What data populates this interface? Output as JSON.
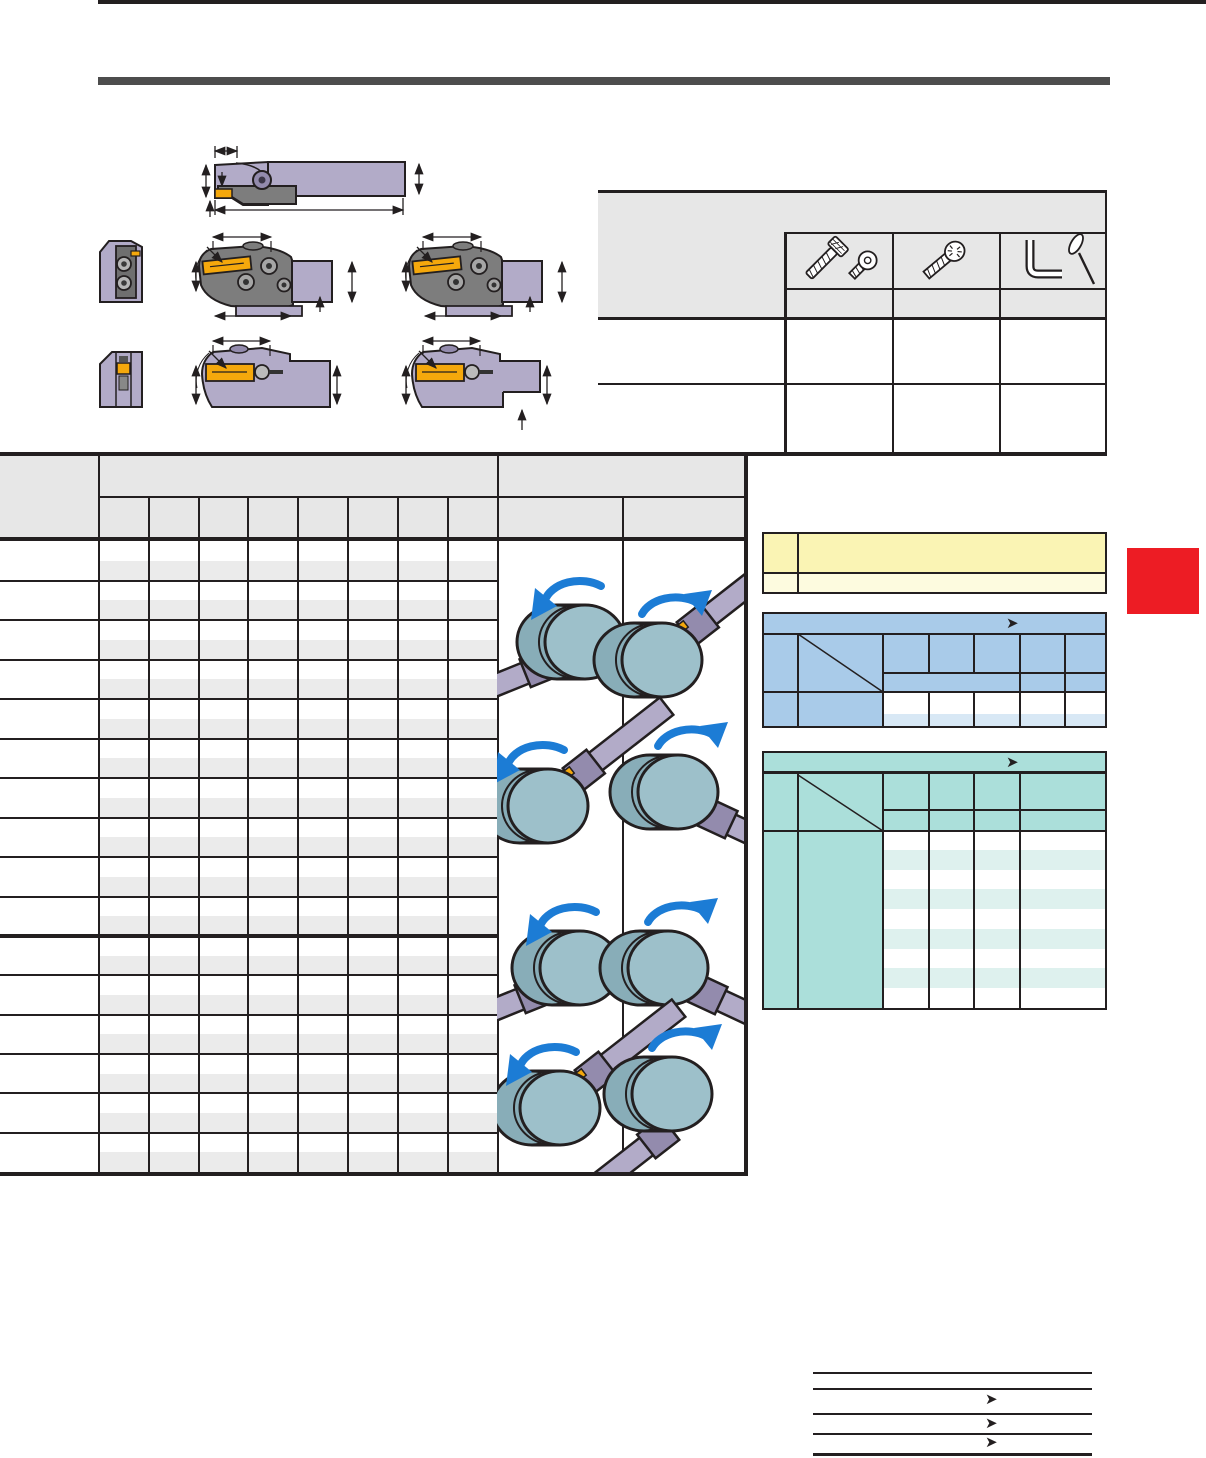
{
  "page": {
    "kind": "tool-catalog-page",
    "top_rule_color": "#231f20",
    "section_rule_color": "#4d4d4d",
    "background": "#ffffff",
    "page_tab_color": "#ed1c24"
  },
  "palette": {
    "border": "#231f20",
    "header_gray": "#e7e7e7",
    "row_stripe_gray": "#ebebeb",
    "holder_purple": "#b2abc8",
    "holder_purple_shade": "#938bad",
    "head_gray": "#7d7d7d",
    "insert_yellow": "#f5a80c",
    "workpiece_face": "#9dc0ca",
    "workpiece_side": "#88adb8",
    "rotation_arrow_blue": "#1c7cd5",
    "note_yellow": "#faf4b4",
    "note_yellow_light": "#fdfbdf",
    "blue_header": "#a9cbe9",
    "blue_stripe": "#d8e8f5",
    "teal_header": "#abdfda",
    "teal_stripe": "#def1ee"
  },
  "technical_drawings": {
    "views": [
      {
        "name": "shank-holder-side-view"
      },
      {
        "name": "modular-head-end-view"
      },
      {
        "name": "modular-head-side-view-right"
      },
      {
        "name": "modular-head-side-view-left"
      },
      {
        "name": "blade-head-end-view"
      },
      {
        "name": "blade-head-side-view-right"
      },
      {
        "name": "blade-head-side-view-left"
      }
    ]
  },
  "spare_parts_table": {
    "columns": [
      {
        "icon": "clamp-screw-icon"
      },
      {
        "icon": "insert-screw-icon"
      },
      {
        "icon": "wrench-screwdriver-icon"
      }
    ],
    "data_row_count": 2
  },
  "main_table": {
    "dimension_subcolumn_count": 8,
    "row_group1_count": 10,
    "row_group2_count": 6,
    "illustration_columns": 2,
    "illustrations": [
      {
        "name": "external-grooving-left-hand",
        "rotation": "counter-clockwise"
      },
      {
        "name": "external-grooving-right-hand",
        "rotation": "clockwise"
      },
      {
        "name": "face-grooving-left-hand",
        "rotation": "counter-clockwise"
      },
      {
        "name": "face-grooving-right-hand",
        "rotation": "clockwise"
      },
      {
        "name": "external-grooving-left-hand-lower",
        "rotation": "counter-clockwise"
      },
      {
        "name": "external-grooving-right-hand-lower",
        "rotation": "clockwise"
      },
      {
        "name": "face-grooving-left-hand-lower",
        "rotation": "counter-clockwise"
      },
      {
        "name": "face-grooving-right-hand-lower",
        "rotation": "clockwise"
      }
    ]
  },
  "side_tables": {
    "yellow_note": {
      "row_count": 2
    },
    "blue_selection": {
      "header_arrow": "➤",
      "data_column_count": 5
    },
    "teal_selection": {
      "header_arrow": "➤",
      "data_column_count": 4,
      "stripe_row_count": 9
    }
  },
  "footer_links": [
    {
      "arrow": "➤"
    },
    {
      "arrow": "➤"
    },
    {
      "arrow": "➤"
    }
  ]
}
